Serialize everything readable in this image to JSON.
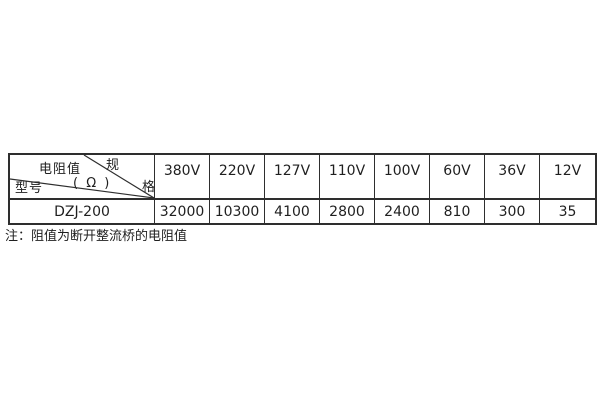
{
  "table": {
    "corner": {
      "spec_char_1": "规",
      "spec_char_2": "格",
      "resistance_label": "电阻值",
      "resistance_unit": "( Ω )",
      "model_label": "型号"
    },
    "voltages": [
      "380V",
      "220V",
      "127V",
      "110V",
      "100V",
      "60V",
      "36V",
      "12V"
    ],
    "rows": [
      {
        "model": "DZJ-200",
        "values": [
          "32000",
          "10300",
          "4100",
          "2800",
          "2400",
          "810",
          "300",
          "35"
        ]
      }
    ]
  },
  "note": {
    "text": "注：阻值为断开整流桥的电阻值"
  },
  "colors": {
    "border": "#2e2e2e",
    "text": "#1f1f1f",
    "background": "#ffffff"
  }
}
